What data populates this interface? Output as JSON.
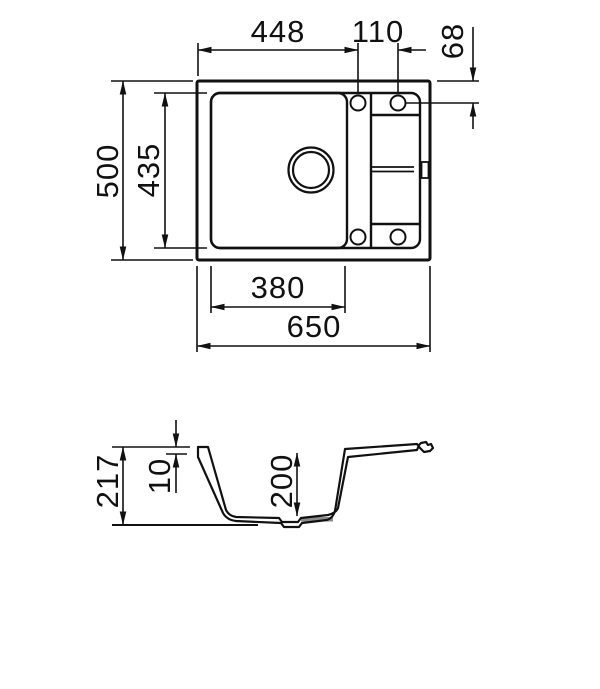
{
  "drawing": {
    "type": "technical-dimension-drawing",
    "subject": "kitchen sink with drainer, top view and cross-section",
    "top_view": {
      "dims": {
        "edge_to_hole_448": "448",
        "hole_spacing_110": "110",
        "hole_offset_68": "68",
        "overall_depth_500": "500",
        "inner_depth_435": "435",
        "bowl_width_380": "380",
        "overall_width_650": "650"
      }
    },
    "section_view": {
      "dims": {
        "overall_height_217": "217",
        "rim_thickness_10": "10",
        "bowl_depth_200": "200"
      }
    },
    "colors": {
      "line": "#111111",
      "background": "#ffffff",
      "drain_fill": "#8c8c8c"
    }
  }
}
